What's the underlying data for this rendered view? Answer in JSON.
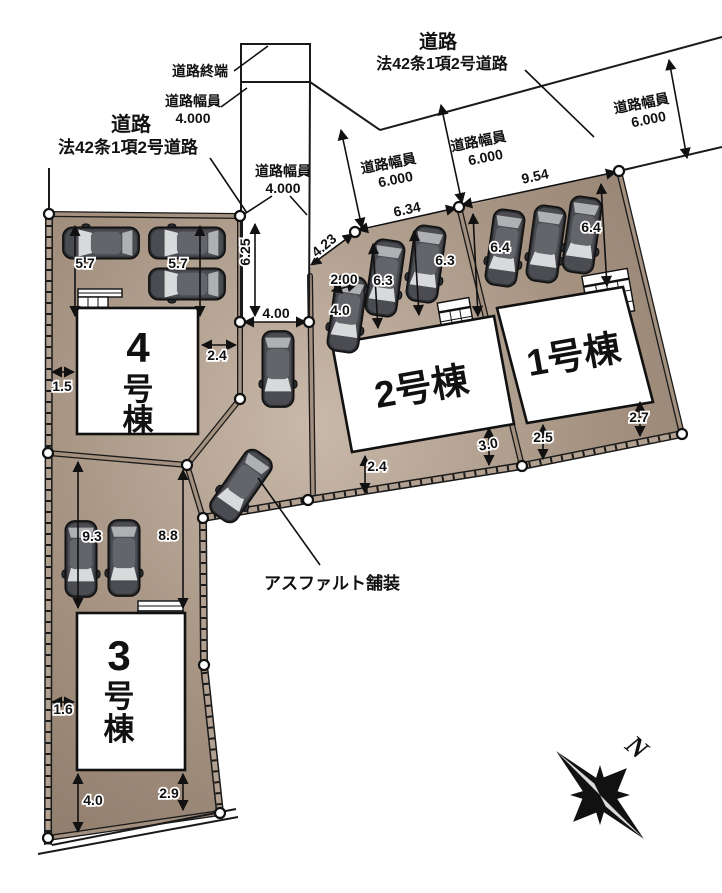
{
  "plan_type": "区画図 (site plan)",
  "colors": {
    "land": "#a3907f",
    "land_light": "#c9b9aa",
    "land_dark": "#8a7767",
    "line": "#1a1a1a",
    "building": "#ffffff",
    "car_body": "#2e2f33",
    "car_roof": "#63656b",
    "car_glass": "#d8d9db"
  },
  "roads": {
    "label_left_line1": "道路",
    "label_left_line2": "法42条1項2号道路",
    "label_top_line1": "道路",
    "label_top_line2": "法42条1項2号道路",
    "road_end_label": "道路終端",
    "width4_top_title": "道路幅員",
    "width4_top_value": "4.000",
    "width4_mid_title": "道路幅員",
    "width4_mid_value": "4.000",
    "width6_a_title": "道路幅員",
    "width6_a_value": "6.000",
    "width6_b_title": "道路幅員",
    "width6_b_value": "6.000",
    "width6_c_title": "道路幅員",
    "width6_c_value": "6.000"
  },
  "buildings": {
    "b1": "1号棟",
    "b2": "2号棟",
    "b3_line1": "3",
    "b3_line2": "号",
    "b3_line3": "棟",
    "b4_line1": "4",
    "b4_line2": "号",
    "b4_line3": "棟"
  },
  "annotations": {
    "asphalt": "アスファルト舗装",
    "north": "N"
  },
  "dims": {
    "lot4_bay1": "5.7",
    "lot4_bay2": "5.7",
    "lot4_w": "1.5",
    "lot4_e": "2.4",
    "road_len": "6.25",
    "road_w": "4.00",
    "lot2_diag": "4.23",
    "lot2_d1": "2.00",
    "lot2_d2": "4.0",
    "lot2_d3": "6.3",
    "lot2_d4": "6.3",
    "lot2_front": "6.34",
    "lot1_front": "9.54",
    "lot1_d1": "6.4",
    "lot1_d2": "6.4",
    "lot2_s1": "2.4",
    "lot2_s2": "3.0",
    "lot1_s1": "2.5",
    "lot1_s2": "2.7",
    "lot3_d1": "9.3",
    "lot3_d2": "8.8",
    "lot3_w": "1.6",
    "lot3_s1": "4.0",
    "lot3_s2": "2.9"
  }
}
